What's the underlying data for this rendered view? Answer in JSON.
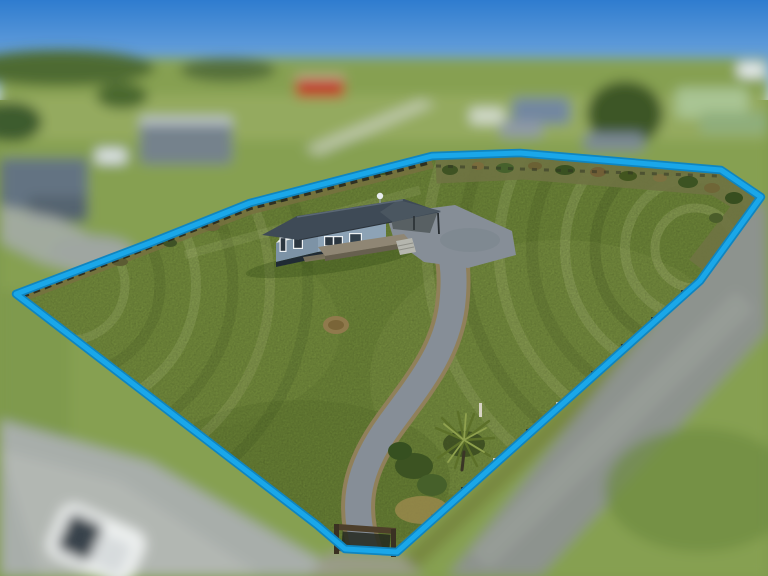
{
  "meta": {
    "type": "aerial-drone-property-photo",
    "width": 768,
    "height": 576,
    "description": "Aerial photo of a rural section outlined in blue: single-storey blue-grey house with dark roof, carport and timber deck, curved gravel driveway to a road entrance with timber gate, mown lawn with mowing arcs, scrub along rear fence, cabbage tree near entrance; surrounding roads, paddocks, neighbouring houses, red barn and a white car are blurred"
  },
  "boundary": {
    "points": "16,294 150,243 250,203 432,156 520,153 721,170 761,197 700,281 397,552 345,549 317,525",
    "color": "#1aa7e9",
    "outline_color": "#0f85c0",
    "stroke_width": "5",
    "outline_width": "8.5"
  },
  "palette": {
    "sky_top": "#2e7ccf",
    "sky_horizon": "#cfe3ee",
    "field": "#86a051",
    "lawn": "#76903d",
    "lawn_light": "#a3b763",
    "driveway_gravel": "#868e97",
    "driveway_edge": "#90805a",
    "road": "#a8aeaa",
    "street": "#8d938e",
    "barn_red": "#bf3a28",
    "car": "#eef1f0",
    "house_roof": "#3e4a56",
    "house_gable": "#e9edf0",
    "house_end_wall": "#7d93a6",
    "house_front_wall": "#8da3b6",
    "house_base": "#202b34",
    "deck": "#8f8674"
  },
  "scene_objects": [
    "sky",
    "blurred-neighbourhood",
    "red-barn",
    "background-road",
    "white-car",
    "street",
    "property-lawn",
    "mowing-stripes",
    "scrub-band",
    "fence-line",
    "gravel-driveway",
    "gravel-parking",
    "house",
    "house-deck",
    "carport",
    "satellite-dish",
    "cabbage-tree",
    "driveway-gate",
    "boundary-outline"
  ]
}
